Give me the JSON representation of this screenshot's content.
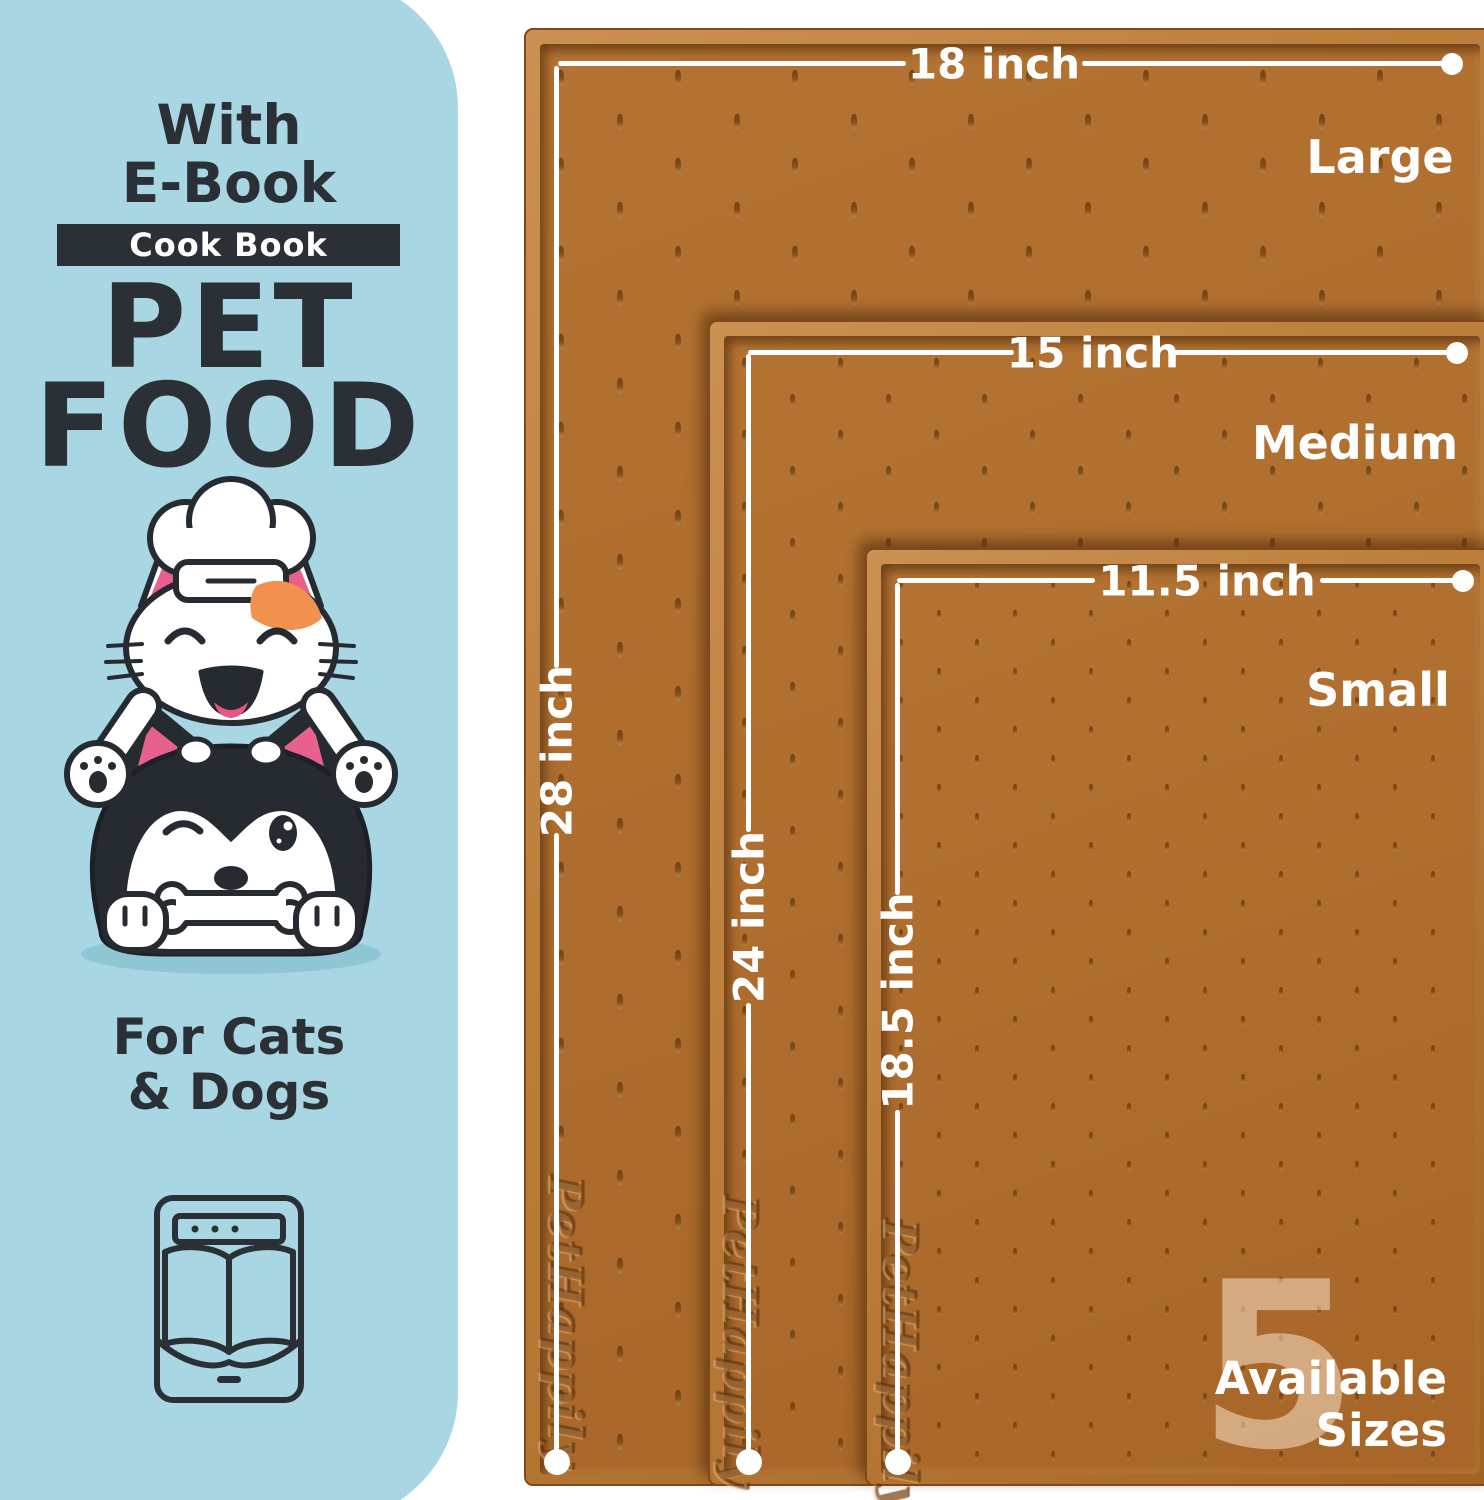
{
  "panel": {
    "with_line1": "With",
    "with_line2": "E-Book",
    "badge": "Cook Book",
    "title_line1": "PET",
    "title_line2": "FOOD",
    "audience_line1": "For Cats",
    "audience_line2": "& Dogs"
  },
  "mats": [
    {
      "size_name": "Large",
      "width_label": "18 inch",
      "length_label": "28 inch"
    },
    {
      "size_name": "Medium",
      "width_label": "15 inch",
      "length_label": "24 inch"
    },
    {
      "size_name": "Small",
      "width_label": "11.5 inch",
      "length_label": "18.5 inch"
    }
  ],
  "brand_embossed": "PetHappily",
  "sizes_badge": {
    "number": "5",
    "line1": "Available",
    "line2": "Sizes"
  },
  "colors": {
    "panel_blue": "#a8d6e2",
    "ink_dark": "#2b2f36",
    "mat_brown": "#ad6c2d",
    "label_white": "#ffffff",
    "accent_orange": "#f0914f",
    "accent_pink": "#e8618c"
  }
}
